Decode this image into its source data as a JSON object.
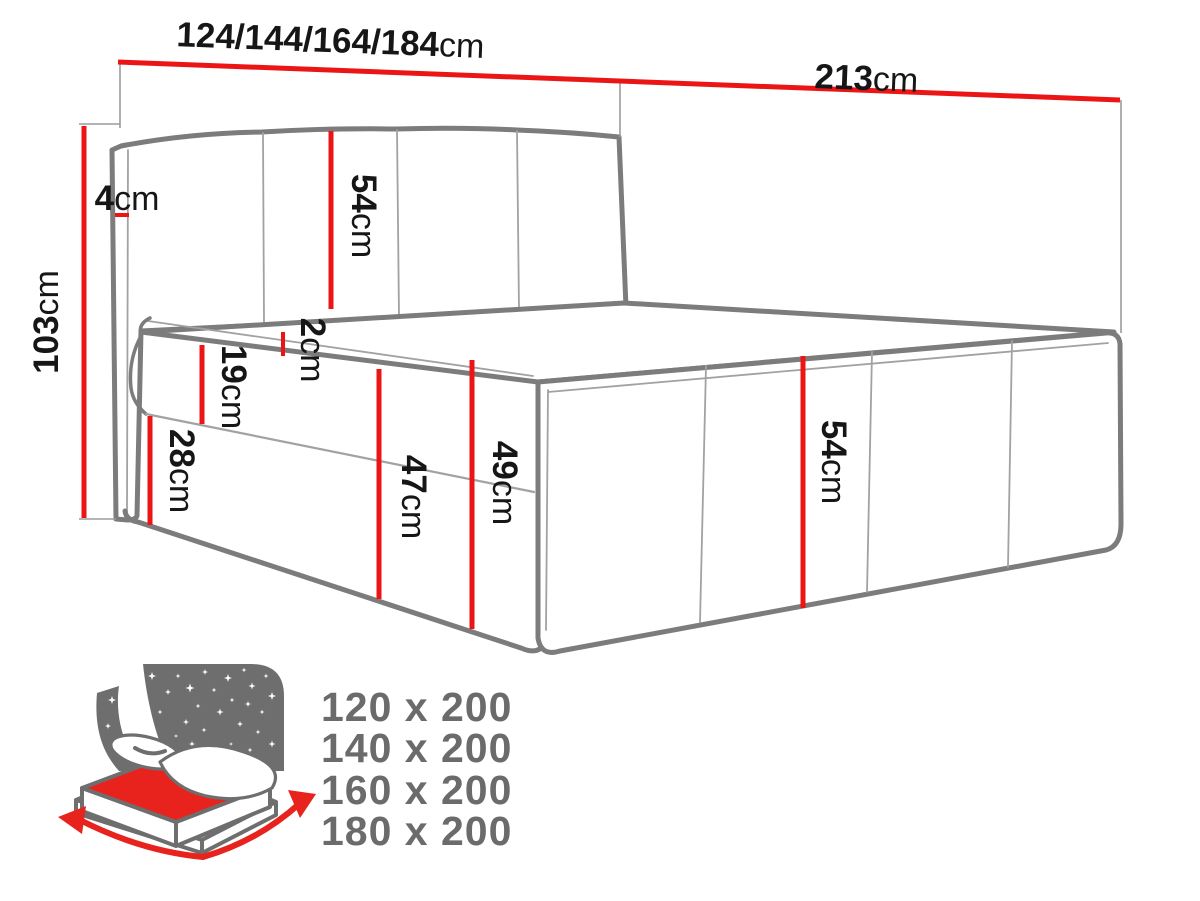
{
  "title": "Boxspring bed dimension diagram",
  "diagram": {
    "dim_top_width": {
      "value": "124/144/164/184",
      "unit": "cm"
    },
    "dim_depth": {
      "value": "213",
      "unit": "cm"
    },
    "dim_total_height": {
      "value": "103",
      "unit": "cm"
    },
    "dim_headboard_depth": {
      "value": "4",
      "unit": "cm"
    },
    "dim_headboard_panel": {
      "value": "54",
      "unit": "cm"
    },
    "dim_topper": {
      "value": "2",
      "unit": "cm"
    },
    "dim_mattress": {
      "value": "19",
      "unit": "cm"
    },
    "dim_base": {
      "value": "28",
      "unit": "cm"
    },
    "dim_side_front": {
      "value": "47",
      "unit": "cm"
    },
    "dim_side_corner": {
      "value": "49",
      "unit": "cm"
    },
    "dim_foot_panel": {
      "value": "54",
      "unit": "cm"
    }
  },
  "size_options": {
    "items": [
      "120 x 200",
      "140 x 200",
      "160 x 200",
      "180 x 200"
    ]
  },
  "colors": {
    "dimension_red": "#ec1515",
    "outline_grey": "#7c7c7c",
    "icon_grey": "#6e6e6e",
    "icon_red": "#e8231d",
    "sizes_grey": "#6b6b6b",
    "ink": "#161616"
  }
}
